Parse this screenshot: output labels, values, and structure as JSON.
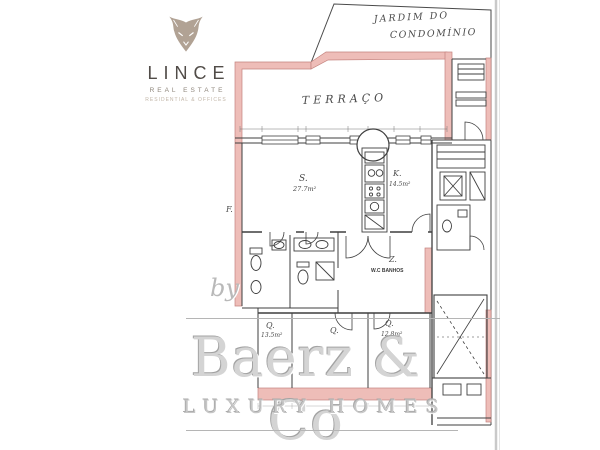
{
  "logo": {
    "brand": "LINCE",
    "subtitle": "REAL ESTATE",
    "tagline": "RESIDENTIAL & OFFICES",
    "icon_color": "#b1a294"
  },
  "handwriting": {
    "garden_line1": "JARDIM DO",
    "garden_line2": "CONDOMÍNIO",
    "terrace": "TERRAÇO",
    "facade_mark": "F."
  },
  "plan": {
    "line_color": "#3f3f3f",
    "wall_pink": "#eebdb8",
    "wall_pink_edge": "#c4837e",
    "rooms": {
      "living": {
        "label": "S.",
        "area": "27.7m²"
      },
      "kitchen": {
        "label": "K.",
        "area": "14.5m²"
      },
      "hall": {
        "label": "Z.",
        "sublabel": "W.C BANHOS"
      },
      "bedroom1": {
        "label": "Q.",
        "area": "13.5m²"
      },
      "bedroom2": {
        "label": "Q."
      },
      "bedroom3": {
        "label": "Q.",
        "area": "12.8m²"
      }
    }
  },
  "watermark": {
    "by": "by",
    "brand": "Baerz & Co",
    "tagline": "LUXURY HOMES"
  }
}
